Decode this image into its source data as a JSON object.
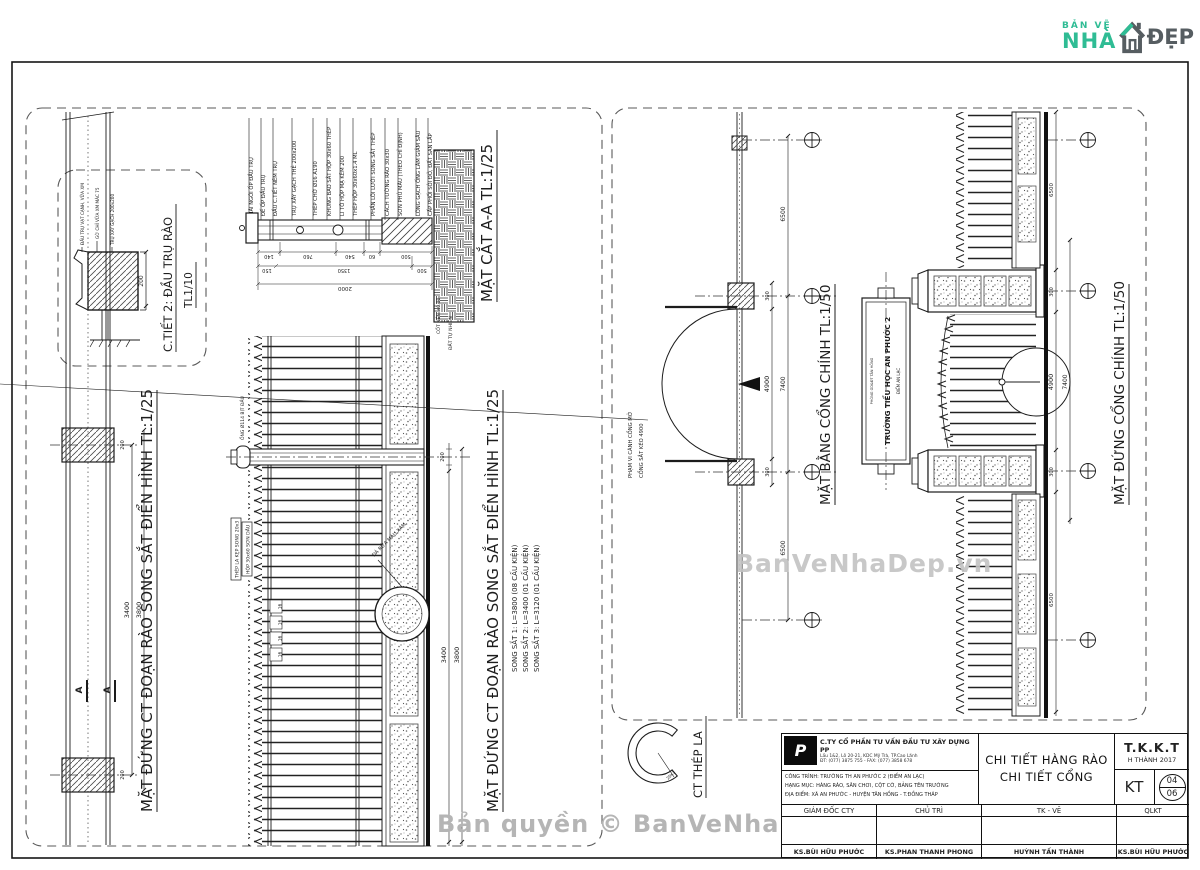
{
  "logo": {
    "line1": "BẢN VẼ",
    "line2": "NHÀ",
    "line3": "ĐẸP"
  },
  "watermark": {
    "center": "BanVeNhaDep.vn",
    "bottom": "Bản quyền © BanVeNhaDep.vn"
  },
  "d": {
    "detail2": {
      "title": "C.TIẾT 2: ĐẦU TRỤ RÀO",
      "scale": "TL1/10",
      "labels": [
        "ĐẦU TRỤ VẠT CẠNH, VỮA XM",
        "GỜ CHỈ VỮA XM MÁC 75",
        "TRỤ XÂY GẠCH 200x200"
      ],
      "dim": "200"
    },
    "fence_plan": {
      "title": "MẶT ĐỨNG CT ĐOẠN RÀO SONG SẮT ĐIỂN HÌNH TL:1/25",
      "mark": "A",
      "dim_span": "3400",
      "dim_total": "3800",
      "dim_post": "200"
    },
    "fence_section": {
      "title": "MẶT CẮT A-A TL:1/25",
      "labels": [
        "MÁI NGÓI ỐP ĐẦU TRỤ",
        "ĐẾ ỐP ĐẦU TRỤ",
        "ĐẦU C.TIẾT NÊM TRỤ",
        "TRỤ XÂY GẠCH THẺ 200x200",
        "THÉP CHỜ Ø16 A190",
        "KHUNG BAO SẮT HỘP 30x60 THÉP",
        "LI TÔ HỘP MẠ KẼM 200",
        "THÉP HỘP 30x60x1.4 ML",
        "PHẦN LÕI LƯỚI SONG SẮT THÉP",
        "CÁCH TƯỜNG RÀO 30x30",
        "SƠN PHỦ MÀU (THEO CHỈ ĐỊNH)",
        "LÓNG GẠCH ỐNG LÀM GIẢM SÂU",
        "CẤP PHỐI SỎI ĐỎ, ĐẤT SAN LẤP"
      ],
      "ground_labels": [
        "CỐT NỀN ±0.00",
        "ĐẤT TỰ NHIÊN"
      ],
      "dims1": [
        "140",
        "760",
        "540",
        "60",
        "500"
      ],
      "dims2": [
        "150",
        "1350",
        "500"
      ],
      "dim_total": "2000"
    },
    "fence_elev": {
      "title": "MẶT ĐỨNG CT ĐOẠN RÀO SONG SẮT ĐIỂN HÌNH TL:1/25",
      "subs": [
        "SONG SẮT 1: L=3800 (08 CẤU KIỆN)",
        "SONG SẮT 2: L=3400 (01 CẤU KIỆN)",
        "SONG SẮT 3: L=3120 (01 CẤU KIỆN)"
      ],
      "box_label1": "THÉP LA KẸP SONG 20x3",
      "box_label2": "HỘP 30x60 SƠN DẦU",
      "post_label": "ỐNG Ø114 BỊT ĐẦU",
      "stone_label": "ĐÁ RỬA MÀU XÁM",
      "ticks": [
        "16",
        "16",
        "16",
        "16"
      ],
      "dim_span": "3400",
      "dim_total": "3800",
      "dim_post": "200"
    },
    "gate_plan": {
      "title": "MẶT BẰNG CỔNG CHÍNH TL:1/50",
      "leader1": "PHẠM VI CÁNH CỔNG MỞ",
      "leader2": "CỔNG SẮT KÉO 4900",
      "dim_post": "300",
      "dim_open": "4900",
      "dim_total": "7400",
      "dim_wing": "6500"
    },
    "gate_elev": {
      "title": "MẶT ĐỨNG CỔNG CHÍNH TL:1/50",
      "sign_top": "PHÒNG GD&ĐT TÂN HỒNG",
      "sign_main": "TRƯỜNG TIỂU HỌC AN PHƯỚC 2",
      "sign_sub": "ĐIỂM AN LẠC",
      "dim_post": "300",
      "dim_open": "4900",
      "dim_total": "7400",
      "dim_wing": "6500"
    },
    "thep_la": {
      "title": "CT THÉP LA",
      "label": "20x3"
    }
  },
  "tb": {
    "company": "C.TY CỔ PHẦN TƯ VẤN ĐẦU TƯ XÂY DỰNG PP",
    "addr1": "Lầu 1&2, Lô 20-21, KDC Mỹ Trà, TP.Cao Lãnh",
    "addr2": "ĐT: (077) 3875 755 - FAX: (077) 3858 678",
    "proj1": "CÔNG TRÌNH: TRƯỜNG TH AN PHƯỚC 2 (ĐIỂM AN LẠC)",
    "proj2": "HẠNG MỤC: HÀNG RÀO, SÂN CHƠI, CỘT CỜ, BẢNG TÊN TRƯỜNG",
    "proj3": "ĐỊA ĐIỂM: XÃ AN PHƯỚC - HUYỆN TÂN HỒNG - T.ĐỒNG THÁP",
    "title1": "CHI TIẾT HÀNG RÀO",
    "title2": "CHI TIẾT CỔNG",
    "stage": "T.K.K.T",
    "stage_sub": "H THÀNH 2017",
    "code": "KT",
    "no": "04",
    "total": "06",
    "h": [
      "GIÁM ĐỐC CTY",
      "CHỦ TRÌ",
      "TK - VẼ",
      "QLKT"
    ],
    "names": [
      "KS.BÙI HỮU PHƯỚC",
      "KS.PHAN THANH PHONG",
      "HUỲNH TẤN THÀNH",
      "KS.BÙI HỮU PHƯỚC"
    ]
  }
}
